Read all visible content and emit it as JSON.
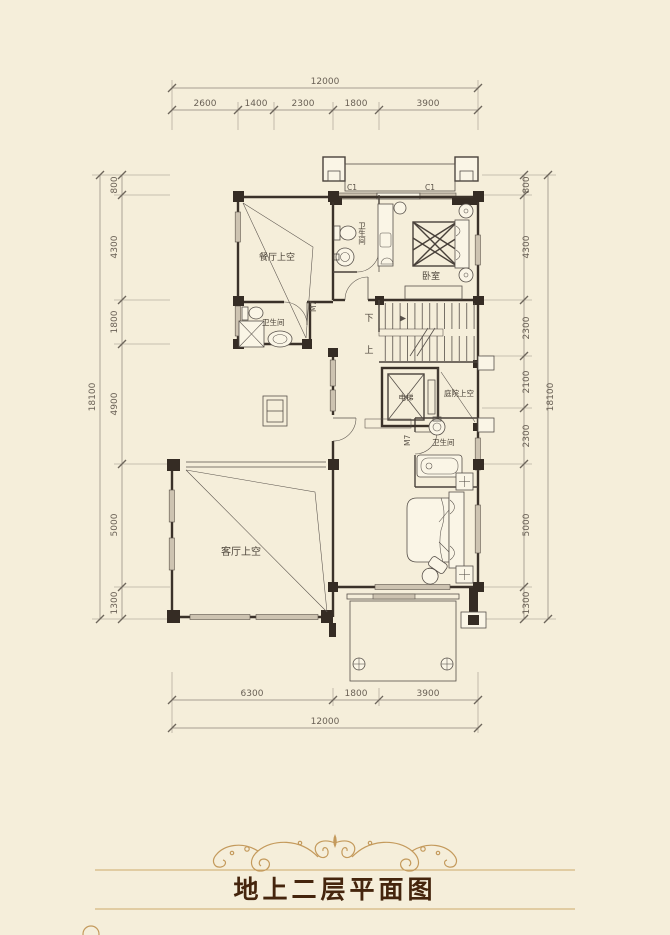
{
  "title": {
    "text": "地上二层平面图"
  },
  "dimensions": {
    "top": {
      "total": "12000",
      "segments": [
        "2600",
        "1400",
        "2300",
        "1800",
        "3900"
      ]
    },
    "bottom": {
      "total": "12000",
      "segments": [
        "6300",
        "1800",
        "3900"
      ]
    },
    "left": {
      "total": "18100",
      "segments": [
        "800",
        "4300",
        "1800",
        "4900",
        "5000",
        "1300"
      ]
    },
    "right": {
      "total": "18100",
      "segments": [
        "800",
        "4300",
        "2300",
        "2100",
        "2300",
        "5000",
        "1300"
      ]
    }
  },
  "rooms": {
    "dining_void": "餐厅上空",
    "bath_top": "卫生间",
    "bedroom": "卧室",
    "bath_left": "卫生间",
    "bath_right": "卫生间",
    "elevator": "电梯",
    "courtyard_void": "庭院上空",
    "living_void": "客厅上空",
    "stairs_down": "下",
    "stairs_up": "上"
  },
  "marks": {
    "door_1": "M7",
    "door_2": "M7",
    "window_1": "C1",
    "window_2": "C1"
  },
  "colors": {
    "background": "#f5eeda",
    "line": "#57504a",
    "wall": "#3a3129",
    "gold": "#c49a5c",
    "title_text": "#45250d",
    "dim_text": "#6a6156"
  }
}
